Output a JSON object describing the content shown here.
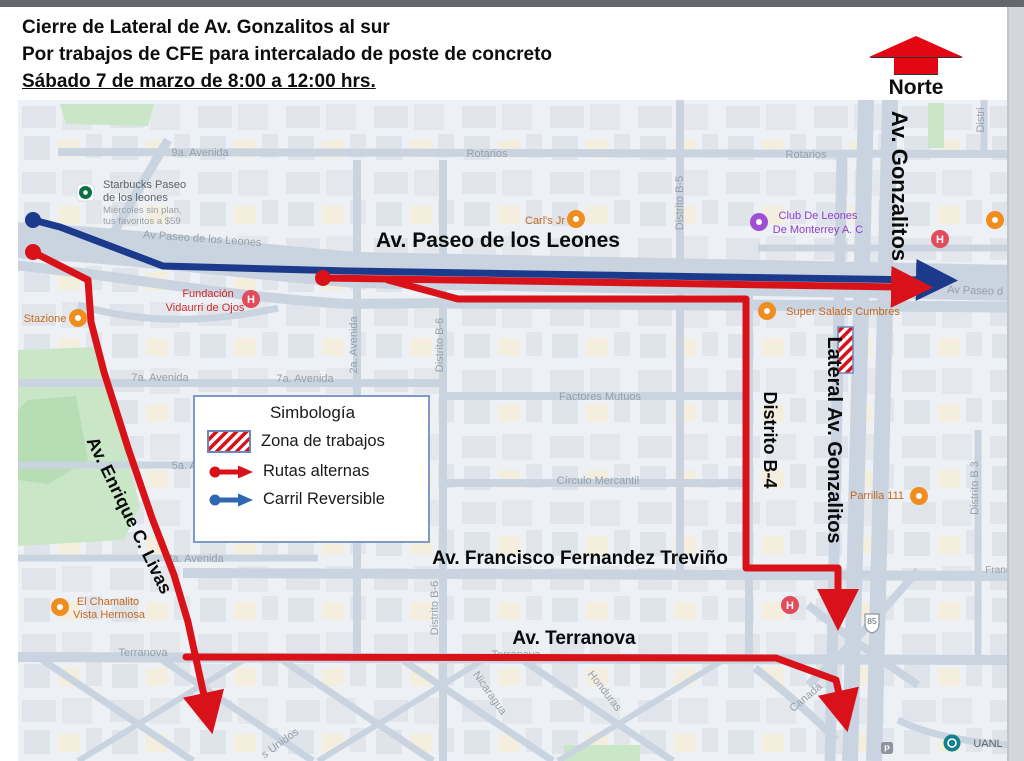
{
  "colors": {
    "route_red": "#d9121a",
    "route_blue": "#1b3a8c",
    "legend_arrow_blue": "#2f68b0",
    "north_red": "#e30613",
    "work_zone_border": "#6b86bd"
  },
  "header": {
    "line1": "Cierre de Lateral de Av. Gonzalitos al sur",
    "line2": "Por trabajos de CFE para intercalado de poste de concreto",
    "line3": "Sábado 7 de marzo de 8:00 a 12:00 hrs."
  },
  "north": {
    "label": "Norte"
  },
  "legend": {
    "title": "Simbología",
    "work_zone": "Zona de trabajos",
    "alt_routes": "Rutas alternas",
    "reversible_lane": "Carril Reversible"
  },
  "map": {
    "streets": {
      "nineA": "9a. Avenida",
      "rotariosL": "Rotarios",
      "rotariosR": "Rotarios",
      "paseoSmallL": "Av Paseo de los Leones",
      "paseoSmallR": "Av Paseo d",
      "sevenA_L": "7a. Avenida",
      "sevenA_R": "7a. Avenida",
      "factores": "Factores Mutuos",
      "fiveA": "5a. Ave",
      "circulo": "Círculo Mercantil",
      "threeA": "3a. Avenida",
      "terranovaL": "Terranova",
      "terranovaM": "Terranova",
      "twoA": "2a. Avenida",
      "b6upper": "Distrito B-6",
      "b6lower": "Distrito B-6",
      "b5": "Distrito B-5",
      "b3": "Distrito B 3",
      "distriTR": "Distri",
      "franc": "Franc",
      "nicaragua": "Nicaragua",
      "honduras": "Honduras",
      "canada": "Canadá",
      "unidos": "s Unidos"
    },
    "avenues": {
      "paseo": "Av. Paseo de los Leones",
      "gonzalitos": "Av. Gonzalitos",
      "lateral": "Lateral Av. Gonzalitos",
      "b4": "Distrito B-4",
      "trevino": "Av. Francisco Fernandez Treviño",
      "terranova": "Av. Terranova",
      "livas": "Av. Enrique C. Livas"
    },
    "pois": {
      "starbucks1": "Starbucks Paseo",
      "starbucks2": "de los leones",
      "starbucksPromo1": "Miércoles sin plan,",
      "starbucksPromo2": "tus favoritos a $59",
      "carls": "Carl's Jr",
      "club1": "Club De Leones",
      "club2": "De Monterrey A. C",
      "fundacion1": "Fundación",
      "fundacion2": "Vidaurri de Ojos",
      "superSalads": "Super Salads Cumbres",
      "parrilla": "Parrilla 111",
      "chamalito1": "El Chamalito",
      "chamalito2": "Vista Hermosa",
      "stazione": "Stazione",
      "uanl": "UANL"
    },
    "icons": {
      "hospital_letter": "H",
      "highway_shield": "85",
      "parking_letter": "P"
    }
  }
}
